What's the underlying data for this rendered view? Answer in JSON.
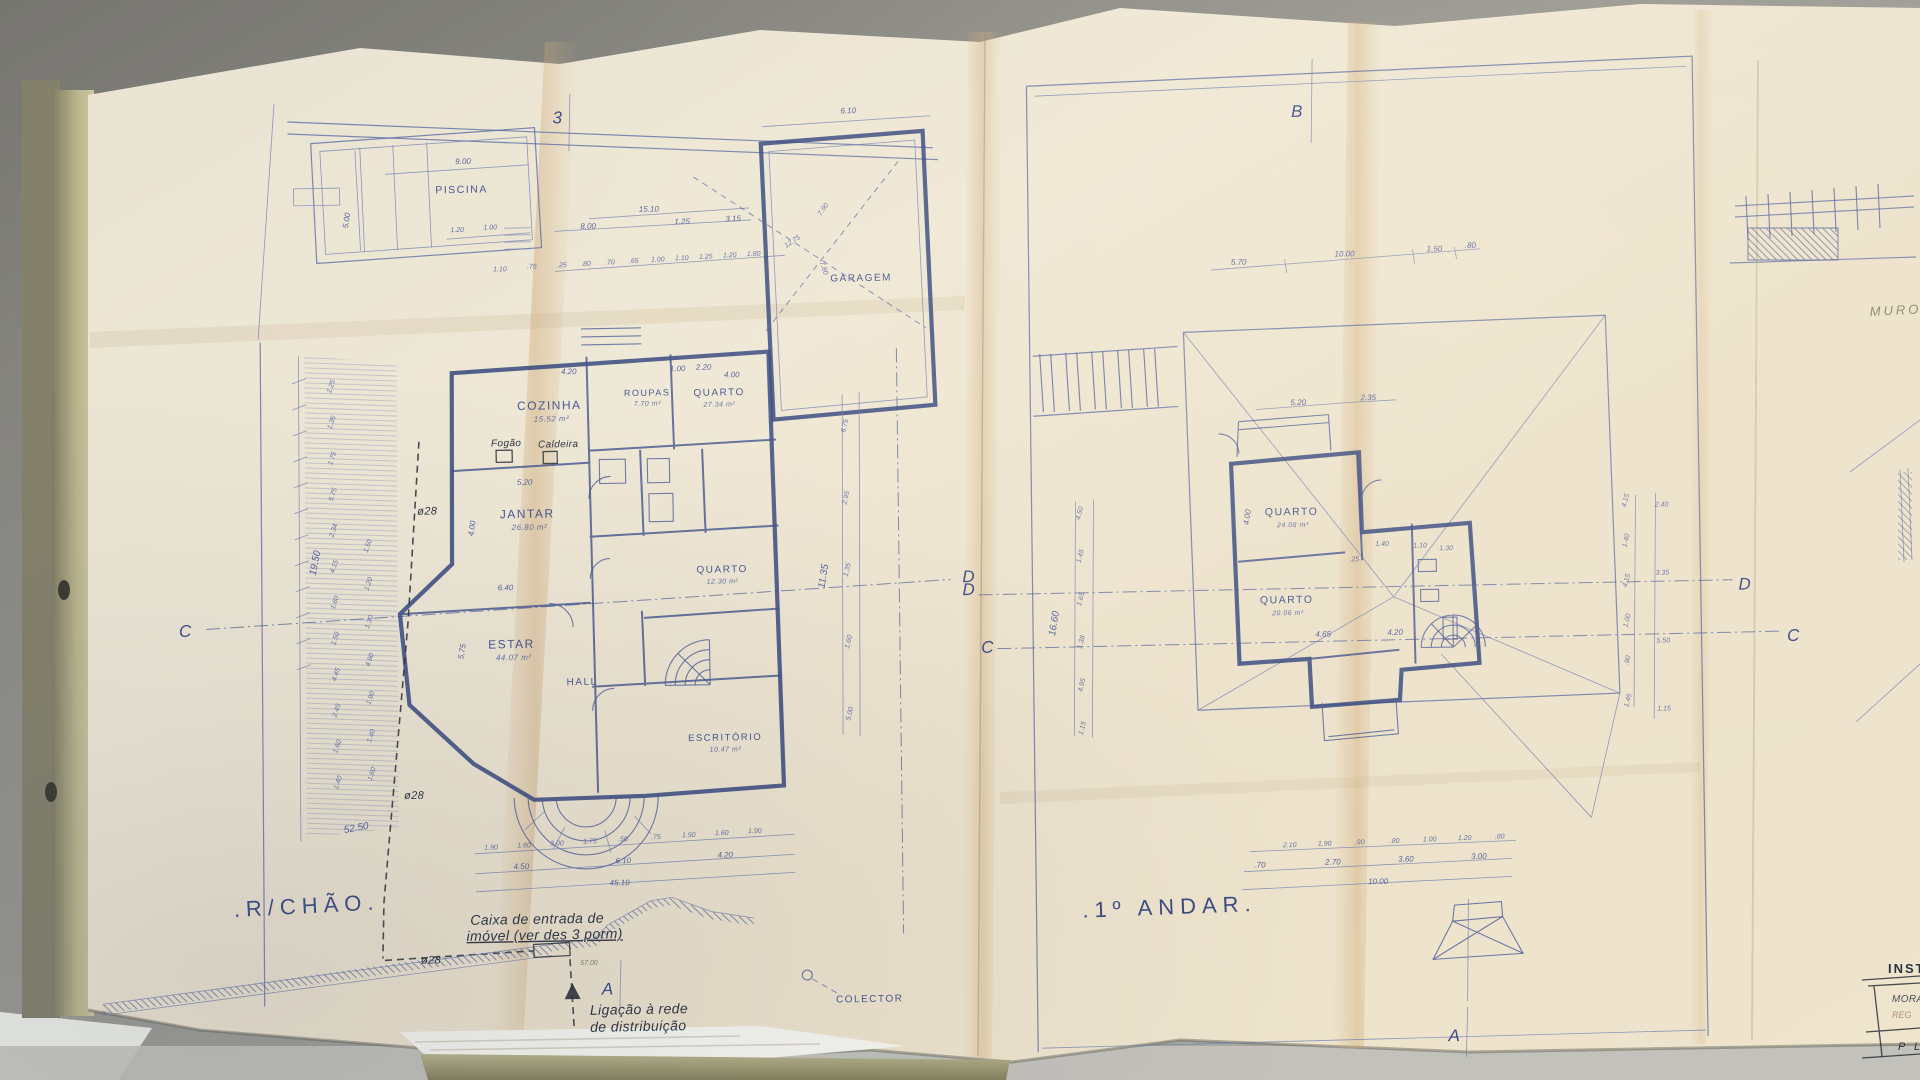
{
  "left": {
    "fold_marker": "3",
    "title": ".R/CHÃO.",
    "pool": {
      "label": "PISCINA",
      "w": "9.00",
      "h": "5.00",
      "a": "1.20",
      "b": "1.00"
    },
    "road": {
      "total": "15.10",
      "d1": "8.00",
      "d2": "1.25",
      "d3": "3.15",
      "small": [
        ".25",
        ".80",
        ".70",
        ".65",
        "1.00",
        "1.10",
        "1.25",
        "1.20",
        "1.80"
      ],
      "e1": "1.10",
      "e2": ".75"
    },
    "garage": {
      "label": "GARAGEM",
      "top_dim": "6.10",
      "diag_a": "12.75",
      "diag_b": "7.90",
      "diag_c": "7.80"
    },
    "rooms": [
      {
        "name": "COZINHA",
        "area": "15.52 m²"
      },
      {
        "name": "ROUPAS",
        "area": "7.70 m²"
      },
      {
        "name": "QUARTO",
        "area": "27.34 m²"
      },
      {
        "name": "JANTAR",
        "area": "26.80 m²"
      },
      {
        "name": "ESTAR",
        "area": "44.07 m²"
      },
      {
        "name": "HALL",
        "area": ""
      },
      {
        "name": "QUARTO",
        "area": "12.30 m²"
      },
      {
        "name": "ESCRITÓRIO",
        "area": "10.47 m²"
      }
    ],
    "fogao": "Fogão",
    "caldeira": "Caldeira",
    "phi": "ø28",
    "dims_left_outer": [
      "1.25",
      "1.35",
      "1.75",
      "5.75",
      "2.34",
      "4.15",
      "1.60",
      "1.50",
      "4.45",
      "2.45",
      "1.60",
      "1.40"
    ],
    "dims_left_inner": [
      "1.50",
      "1.20",
      "1.30",
      "4.90",
      "1.90",
      "1.40",
      "1.60"
    ],
    "dims_left_total": "19.50",
    "dims_left_slope": "52.50",
    "dims_right": [
      "6.75",
      "2.95",
      "1.35",
      "1.60",
      "5.00"
    ],
    "dims_right_total": "11.35",
    "dims_house_top": [
      "4.20",
      "1.00",
      "2.20",
      "4.00"
    ],
    "dims_mid": {
      "a": "5.20",
      "b": "4.00",
      "c": "6.40",
      "d": "5.75"
    },
    "bottom_row1": [
      "1.90",
      "1.60",
      "3.00",
      "1.75",
      ".50",
      ".75",
      "1.50",
      "1.60",
      "1.90"
    ],
    "bottom_row2": [
      "4.50",
      "6.10",
      "4.20"
    ],
    "bottom_total": "45.10",
    "annotations": {
      "caixa1": "Caixa de entrada de",
      "caixa2": "imóvel (ver des 3 porm)",
      "ligacao1": "Ligação à rede",
      "ligacao2": "de distribuição",
      "colector": "COLECTOR",
      "run": "57.00"
    },
    "markers": {
      "c": "C",
      "d": "D",
      "a": "A"
    }
  },
  "right": {
    "fold_marker": "B",
    "title": ".1º ANDAR.",
    "rooms": [
      {
        "name": "QUARTO",
        "area": "24.08 m²"
      },
      {
        "name": "QUARTO",
        "area": "20.06 m²"
      }
    ],
    "top_dims": [
      "5.70",
      "10.00",
      "1.50",
      ".80"
    ],
    "left_dims": [
      "4.50",
      "1.45",
      "1.65",
      "1.38",
      "4.95",
      "1.15"
    ],
    "left_total": "16.60",
    "right_dims": [
      "2.40",
      "3.35",
      "5.50",
      "1.15"
    ],
    "right_chain": [
      "4.15",
      "1.40",
      "4.15",
      "1.00",
      ".90",
      "1.45"
    ],
    "inner": {
      "a": "5.20",
      "b": "2.35",
      "c": "4.00",
      "d": "1.40",
      "e": ".25",
      "f": "4.65",
      "g": "4.20",
      "h": "1.10",
      "i": "1.30"
    },
    "bottom_row1": [
      "2.10",
      "1.90",
      ".90",
      ".80",
      "1.00",
      "1.20",
      ".80"
    ],
    "bottom_row2": [
      ".70",
      "2.70",
      "3.60",
      "3.00"
    ],
    "bottom_total": "10.00",
    "markers": {
      "b": "B",
      "c": "C",
      "d": "D",
      "a": "A"
    }
  },
  "side": {
    "muro": "MURO",
    "block_title": "INSTAL",
    "block_line1": "MORAD",
    "block_line2": "REG",
    "block_line3": "P L"
  }
}
